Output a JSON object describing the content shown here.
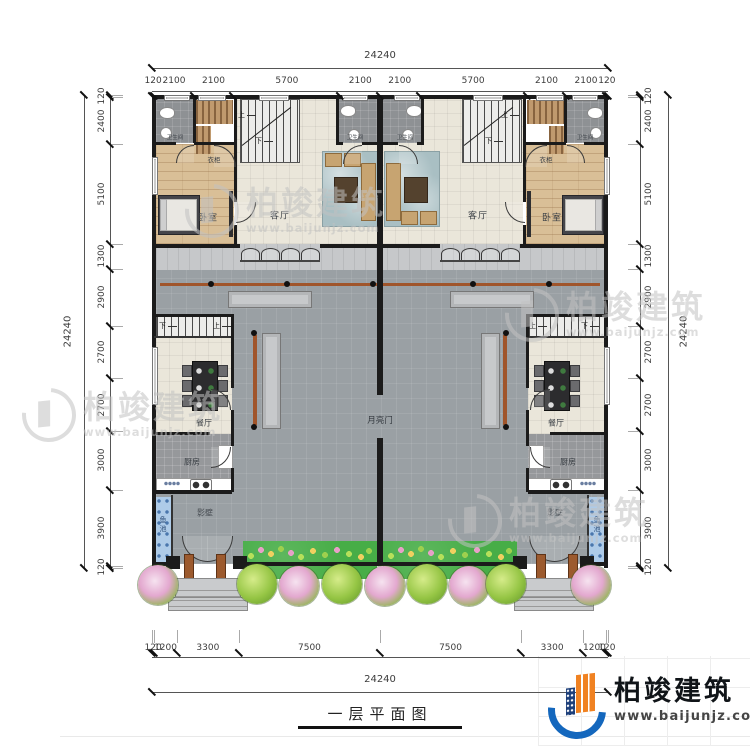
{
  "title": {
    "text": "一层平面图"
  },
  "brand": {
    "name": "柏竣建筑",
    "url": "www.baijunjz.com"
  },
  "watermark": {
    "name": "柏竣建筑",
    "url": "www.baijunjz.com"
  },
  "dimensions": {
    "top": {
      "total": "24240",
      "segments": [
        "120",
        "2100",
        "2100",
        "5700",
        "2100",
        "2100",
        "5700",
        "2100",
        "2100",
        "120"
      ]
    },
    "bottom": {
      "total": "24240",
      "segments": [
        "120",
        "1200",
        "3300",
        "7500",
        "7500",
        "3300",
        "1200",
        "120"
      ]
    },
    "left": {
      "total": "24240",
      "segments": [
        "120",
        "2400",
        "5100",
        "1300",
        "2900",
        "2700",
        "2700",
        "3000",
        "3900",
        "120"
      ]
    },
    "right": {
      "total": "24240",
      "segments": [
        "120",
        "2400",
        "5100",
        "1300",
        "2900",
        "2700",
        "2700",
        "3000",
        "3900",
        "120"
      ]
    }
  },
  "rooms": {
    "bathroom": "卫生间",
    "wardrobe": "衣柜",
    "bedroom": "卧室",
    "living": "客厅",
    "dining": "餐厅",
    "kitchen": "厨房",
    "screen_wall": "影壁",
    "fish_pond": "鱼池",
    "moon_gate": "月亮门",
    "stair_up": "上",
    "stair_down": "下"
  },
  "colors": {
    "wall": "#1b1b1b",
    "courtyard": "#9aa0a4",
    "room": "#eae6da",
    "wood": "#d9bf97",
    "water": "#aecbe8",
    "garden": "#47ad47",
    "beam": "#a0552b",
    "logo_blue": "#1467bd",
    "logo_orange": "#f08222"
  }
}
